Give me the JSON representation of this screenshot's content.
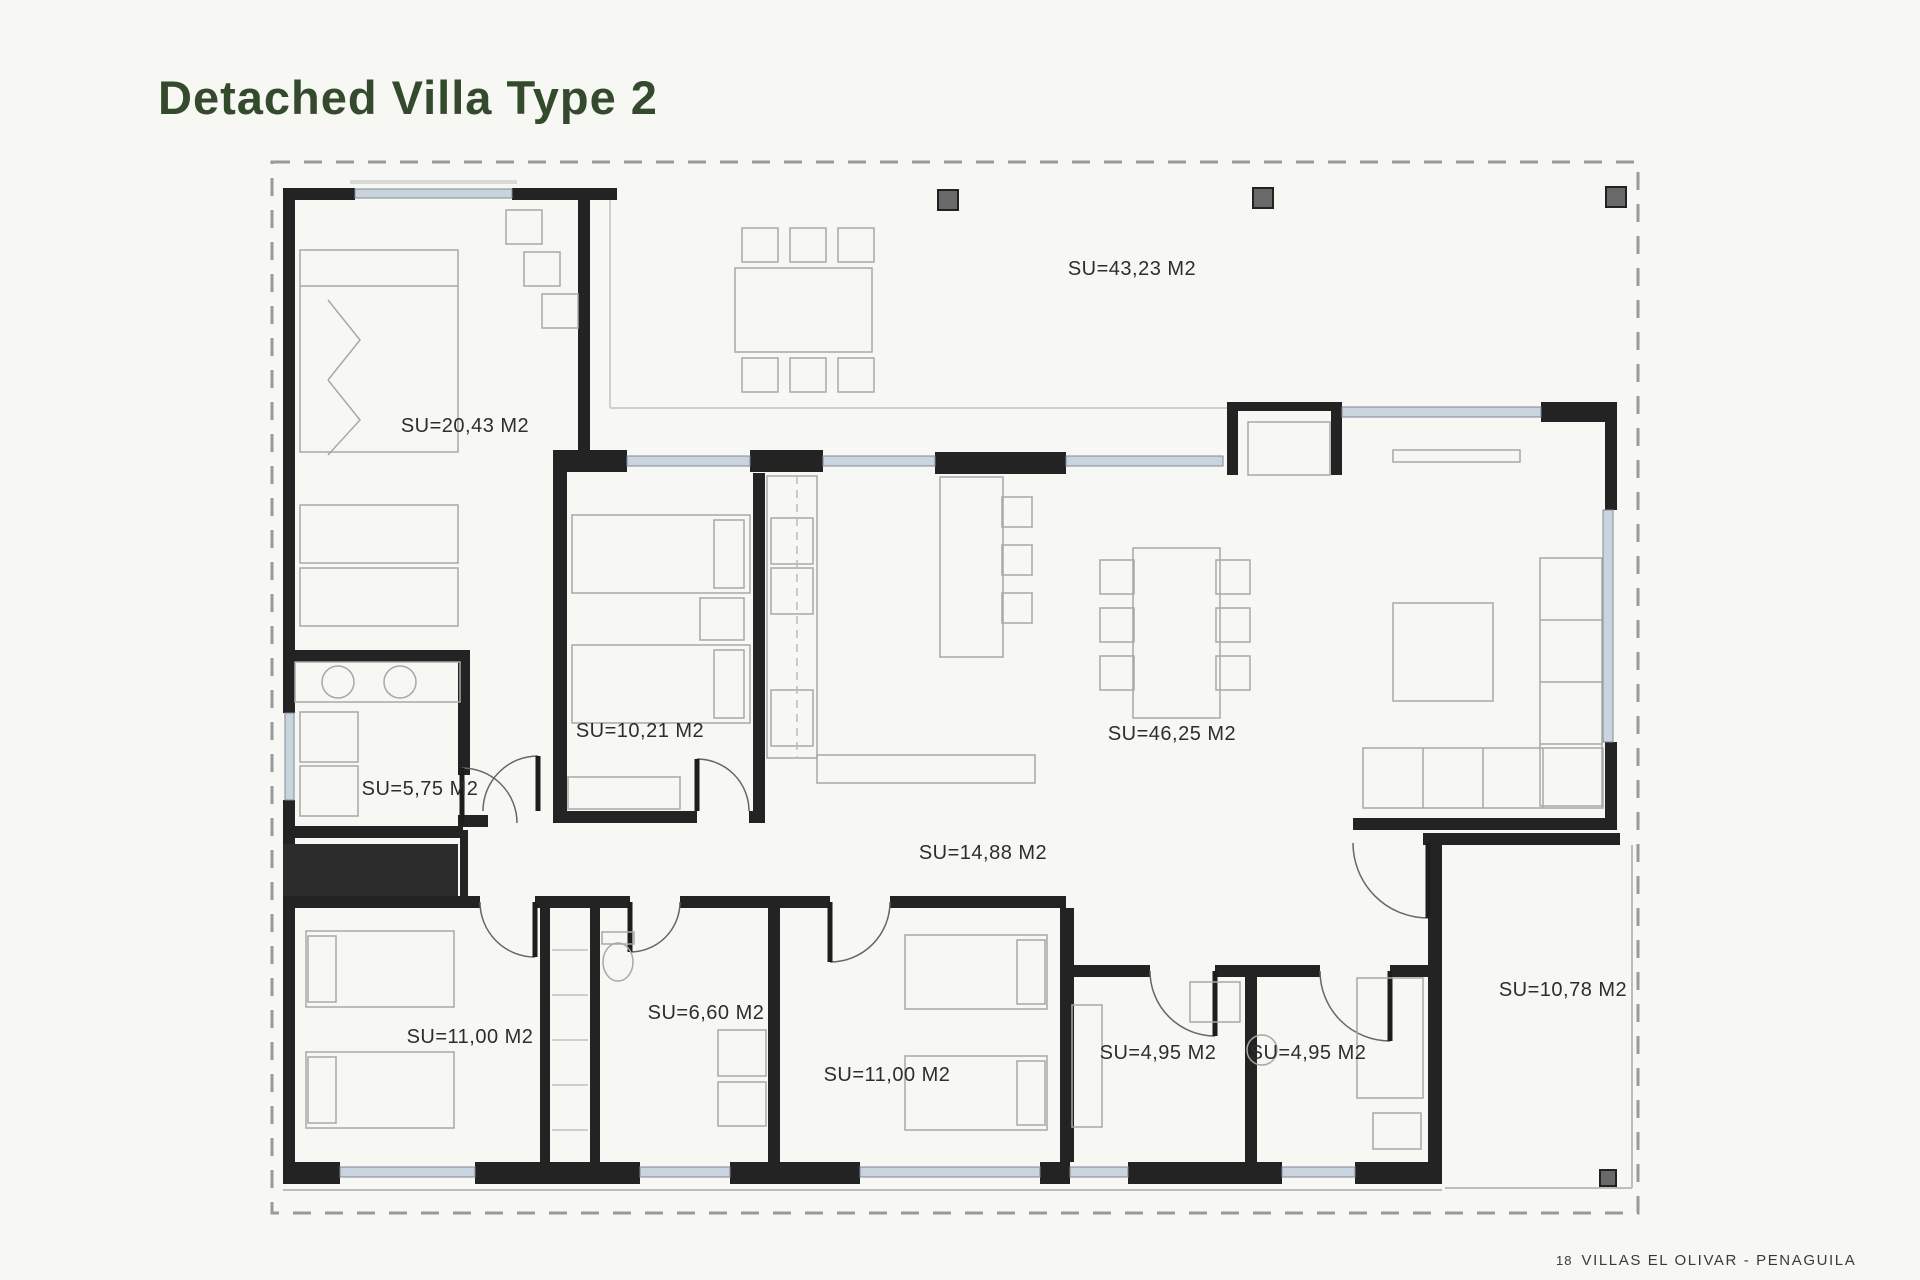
{
  "header": {
    "title": "Detached Villa Type 2",
    "title_color": "#344a2c"
  },
  "footer": {
    "page_number": "18",
    "project": "VILLAS EL OLIVAR - PENAGUILA"
  },
  "plan": {
    "drawing_title": "Detached Villa Type 2 floor plan",
    "area_unit": "M2",
    "rooms": [
      {
        "name": "terrace",
        "label": "SU=43,23 M2"
      },
      {
        "name": "master-bedroom",
        "label": "SU=20,43 M2"
      },
      {
        "name": "bedroom-2",
        "label": "SU=10,21 M2"
      },
      {
        "name": "laundry",
        "label": "SU=5,75 M2"
      },
      {
        "name": "living-dining-kitchen",
        "label": "SU=46,25 M2"
      },
      {
        "name": "hallway",
        "label": "SU=14,88 M2"
      },
      {
        "name": "bedroom-3",
        "label": "SU=11,00 M2"
      },
      {
        "name": "bathroom-1",
        "label": "SU=6,60 M2"
      },
      {
        "name": "bedroom-4",
        "label": "SU=11,00 M2"
      },
      {
        "name": "bathroom-2",
        "label": "SU=4,95 M2"
      },
      {
        "name": "bathroom-3",
        "label": "SU=4,95 M2"
      },
      {
        "name": "entrance-porch",
        "label": "SU=10,78 M2"
      }
    ],
    "colors": {
      "wall": "#232323",
      "window_glass": "#c9d4df",
      "plot_boundary": "#9a9a9a",
      "furniture_line": "#a8a8a8",
      "column_fill": "#696969"
    }
  }
}
